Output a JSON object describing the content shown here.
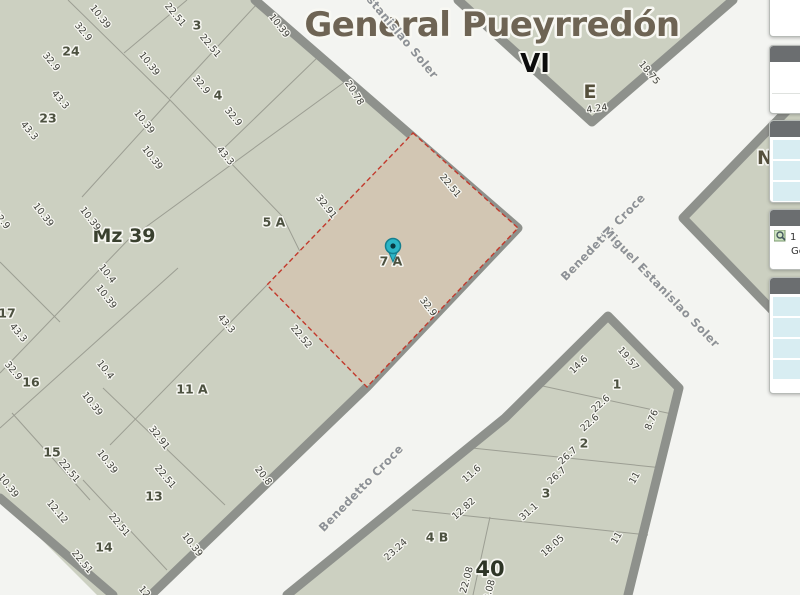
{
  "map": {
    "bg": "#f3f4f1",
    "block_fill": "#ccd0c1",
    "road_color": "#8e918c",
    "parcel_line_color": "#9c9e93",
    "title": "General Pueyrredón",
    "blocks": [
      "0,0 255,0 518,228 367,387 151,595 97,595 0,498",
      "458,0 733,0 592,122",
      "805,92 683,218 805,344",
      "287,595 505,418 608,316 679,388 628,595"
    ],
    "roads": [
      "255,0 518,228 367,387 151,595",
      "0,498 113,595",
      "458,0 592,122 733,0",
      "805,92 683,218 805,344",
      "287,595 505,418 608,316 679,388 628,595"
    ],
    "parcel_lines": [
      "68,0 170,100 283,217 358,370",
      "350,78 128,240 0,373",
      "170,100 82,197",
      "124,53 187,0",
      "170,98 257,4",
      "222,150 318,57",
      "178,268 0,428",
      "103,388 225,505",
      "83,480 167,570",
      "12,413 90,500",
      "0,262 60,322",
      "267,285 110,445",
      "538,385 672,414",
      "472,448 663,468",
      "412,510 648,535",
      "490,517 473,595"
    ],
    "selected_parcel": {
      "label": "7 A",
      "points": "413,133 518,228 367,387 267,285",
      "fill": "#d2c6b3",
      "border": "#c2392c"
    },
    "marker": {
      "x": 393,
      "y": 246,
      "fill": "#2bb5c6",
      "stroke": "#157f8f",
      "dot": "#083840"
    },
    "labels": [
      {
        "t": "General Pueyrredón",
        "x": 492,
        "y": 25,
        "r": 0,
        "k": "title"
      },
      {
        "t": "VI",
        "x": 535,
        "y": 64,
        "r": 0,
        "k": "vi"
      },
      {
        "t": "E",
        "x": 590,
        "y": 92,
        "r": 0,
        "k": "blocksm"
      },
      {
        "t": "N",
        "x": 765,
        "y": 158,
        "r": 0,
        "k": "blocksm"
      },
      {
        "t": "Mz 39",
        "x": 124,
        "y": 236,
        "r": 0,
        "k": "block"
      },
      {
        "t": "40",
        "x": 490,
        "y": 569,
        "r": 0,
        "k": "block40"
      },
      {
        "t": "Estanislao Soler",
        "x": 400,
        "y": 34,
        "r": 50,
        "k": "street"
      },
      {
        "t": "Benedetto Croce",
        "x": 603,
        "y": 237,
        "r": -46,
        "k": "street"
      },
      {
        "t": "Miguel Estanislao Soler",
        "x": 661,
        "y": 287,
        "r": 46,
        "k": "street"
      },
      {
        "t": "Benedetto Croce",
        "x": 361,
        "y": 488,
        "r": -46,
        "k": "street"
      },
      {
        "t": "3",
        "x": 197,
        "y": 25,
        "r": 0,
        "k": "num"
      },
      {
        "t": "24",
        "x": 71,
        "y": 51,
        "r": 0,
        "k": "num"
      },
      {
        "t": "4",
        "x": 218,
        "y": 95,
        "r": 0,
        "k": "num"
      },
      {
        "t": "23",
        "x": 48,
        "y": 118,
        "r": 0,
        "k": "num"
      },
      {
        "t": "5 A",
        "x": 274,
        "y": 222,
        "r": 0,
        "k": "num"
      },
      {
        "t": "7 A",
        "x": 391,
        "y": 261,
        "r": 0,
        "k": "num"
      },
      {
        "t": "17",
        "x": 7,
        "y": 313,
        "r": 0,
        "k": "num"
      },
      {
        "t": "16",
        "x": 31,
        "y": 382,
        "r": 0,
        "k": "num"
      },
      {
        "t": "11 A",
        "x": 192,
        "y": 389,
        "r": 0,
        "k": "num"
      },
      {
        "t": "15",
        "x": 52,
        "y": 452,
        "r": 0,
        "k": "num"
      },
      {
        "t": "13",
        "x": 154,
        "y": 496,
        "r": 0,
        "k": "num"
      },
      {
        "t": "14",
        "x": 104,
        "y": 547,
        "r": 0,
        "k": "num"
      },
      {
        "t": "1",
        "x": 617,
        "y": 384,
        "r": 0,
        "k": "num"
      },
      {
        "t": "2",
        "x": 584,
        "y": 443,
        "r": 0,
        "k": "num"
      },
      {
        "t": "3",
        "x": 546,
        "y": 493,
        "r": 0,
        "k": "num"
      },
      {
        "t": "4 B",
        "x": 437,
        "y": 537,
        "r": 0,
        "k": "num"
      },
      {
        "t": "10.39",
        "x": 100,
        "y": 17,
        "r": 52,
        "k": "dim"
      },
      {
        "t": "22.51",
        "x": 175,
        "y": 15,
        "r": 50,
        "k": "dim"
      },
      {
        "t": "32.9",
        "x": 83,
        "y": 32,
        "r": 50,
        "k": "dim"
      },
      {
        "t": "10.39",
        "x": 149,
        "y": 64,
        "r": 52,
        "k": "dim"
      },
      {
        "t": "22.51",
        "x": 210,
        "y": 46,
        "r": 50,
        "k": "dim"
      },
      {
        "t": "32.9",
        "x": 51,
        "y": 62,
        "r": 50,
        "k": "dim"
      },
      {
        "t": "32.9",
        "x": 201,
        "y": 85,
        "r": 50,
        "k": "dim"
      },
      {
        "t": "43.3",
        "x": 60,
        "y": 100,
        "r": 50,
        "k": "dim"
      },
      {
        "t": "32.9",
        "x": 233,
        "y": 117,
        "r": 50,
        "k": "dim"
      },
      {
        "t": "43.3",
        "x": 29,
        "y": 131,
        "r": 50,
        "k": "dim"
      },
      {
        "t": "10.39",
        "x": 144,
        "y": 122,
        "r": 52,
        "k": "dim"
      },
      {
        "t": "43.3",
        "x": 225,
        "y": 156,
        "r": 50,
        "k": "dim"
      },
      {
        "t": "10.39",
        "x": 152,
        "y": 158,
        "r": 52,
        "k": "dim"
      },
      {
        "t": "10.39",
        "x": 279,
        "y": 26,
        "r": 52,
        "k": "dim"
      },
      {
        "t": "20.78",
        "x": 354,
        "y": 93,
        "r": 58,
        "k": "dim"
      },
      {
        "t": "18.75",
        "x": 649,
        "y": 73,
        "r": 50,
        "k": "dim"
      },
      {
        "t": "4.24",
        "x": 597,
        "y": 109,
        "r": -8,
        "k": "dim"
      },
      {
        "t": "32.9",
        "x": 1,
        "y": 220,
        "r": 50,
        "k": "dim"
      },
      {
        "t": "10.39",
        "x": 43,
        "y": 215,
        "r": 52,
        "k": "dim"
      },
      {
        "t": "10.39",
        "x": 90,
        "y": 219,
        "r": 52,
        "k": "dim"
      },
      {
        "t": "10.4",
        "x": 107,
        "y": 274,
        "r": 52,
        "k": "dim"
      },
      {
        "t": "10.39",
        "x": 106,
        "y": 297,
        "r": 52,
        "k": "dim"
      },
      {
        "t": "43.3",
        "x": 18,
        "y": 333,
        "r": 50,
        "k": "dim"
      },
      {
        "t": "43.3",
        "x": 226,
        "y": 324,
        "r": 50,
        "k": "dim"
      },
      {
        "t": "32.9",
        "x": 13,
        "y": 371,
        "r": 50,
        "k": "dim"
      },
      {
        "t": "10.4",
        "x": 105,
        "y": 370,
        "r": 52,
        "k": "dim"
      },
      {
        "t": "10.39",
        "x": 92,
        "y": 404,
        "r": 52,
        "k": "dim"
      },
      {
        "t": "32.91",
        "x": 326,
        "y": 207,
        "r": 52,
        "k": "dim"
      },
      {
        "t": "22.51",
        "x": 450,
        "y": 186,
        "r": 50,
        "k": "dim"
      },
      {
        "t": "32.9",
        "x": 428,
        "y": 307,
        "r": 52,
        "k": "dim"
      },
      {
        "t": "22.52",
        "x": 301,
        "y": 337,
        "r": 50,
        "k": "dim"
      },
      {
        "t": "32.91",
        "x": 159,
        "y": 438,
        "r": 52,
        "k": "dim"
      },
      {
        "t": "22.51",
        "x": 69,
        "y": 471,
        "r": 50,
        "k": "dim"
      },
      {
        "t": "22.51",
        "x": 165,
        "y": 477,
        "r": 50,
        "k": "dim"
      },
      {
        "t": "10.39",
        "x": 107,
        "y": 462,
        "r": 52,
        "k": "dim"
      },
      {
        "t": "10.39",
        "x": 8,
        "y": 486,
        "r": 52,
        "k": "dim"
      },
      {
        "t": "12.12",
        "x": 57,
        "y": 512,
        "r": 50,
        "k": "dim"
      },
      {
        "t": "22.51",
        "x": 119,
        "y": 525,
        "r": 50,
        "k": "dim"
      },
      {
        "t": "22.51",
        "x": 82,
        "y": 562,
        "r": 50,
        "k": "dim"
      },
      {
        "t": "10.39",
        "x": 192,
        "y": 545,
        "r": 52,
        "k": "dim"
      },
      {
        "t": "20.8",
        "x": 263,
        "y": 476,
        "r": 52,
        "k": "dim"
      },
      {
        "t": "12",
        "x": 144,
        "y": 592,
        "r": 50,
        "k": "dim"
      },
      {
        "t": "19.57",
        "x": 628,
        "y": 359,
        "r": 50,
        "k": "dim"
      },
      {
        "t": "14.6",
        "x": 579,
        "y": 365,
        "r": -45,
        "k": "dim"
      },
      {
        "t": "22.6",
        "x": 601,
        "y": 404,
        "r": -42,
        "k": "dim"
      },
      {
        "t": "22.6",
        "x": 590,
        "y": 423,
        "r": -42,
        "k": "dim"
      },
      {
        "t": "8.76",
        "x": 652,
        "y": 420,
        "r": -68,
        "k": "dim"
      },
      {
        "t": "26.7",
        "x": 568,
        "y": 456,
        "r": -42,
        "k": "dim"
      },
      {
        "t": "26.7",
        "x": 557,
        "y": 476,
        "r": -42,
        "k": "dim"
      },
      {
        "t": "11",
        "x": 635,
        "y": 478,
        "r": -60,
        "k": "dim"
      },
      {
        "t": "31.1",
        "x": 529,
        "y": 512,
        "r": -42,
        "k": "dim"
      },
      {
        "t": "18.05",
        "x": 553,
        "y": 546,
        "r": -42,
        "k": "dim"
      },
      {
        "t": "11",
        "x": 617,
        "y": 538,
        "r": -60,
        "k": "dim"
      },
      {
        "t": "11.6",
        "x": 472,
        "y": 474,
        "r": -42,
        "k": "dim"
      },
      {
        "t": "12.82",
        "x": 464,
        "y": 509,
        "r": -42,
        "k": "dim"
      },
      {
        "t": "23.24",
        "x": 396,
        "y": 550,
        "r": -42,
        "k": "dim"
      },
      {
        "t": "22.08",
        "x": 467,
        "y": 580,
        "r": -75,
        "k": "dim"
      },
      {
        "t": "22.08",
        "x": 489,
        "y": 593,
        "r": -75,
        "k": "dim"
      }
    ]
  },
  "panels": {
    "header_color": "#6b6e70",
    "row_color": "#d8edf2",
    "items": [
      {
        "top": -9,
        "height": 46,
        "type": "plain"
      },
      {
        "top": 45,
        "height": 69,
        "type": "divided"
      },
      {
        "top": 120,
        "height": 83,
        "type": "rows",
        "rows": 3
      },
      {
        "top": 209,
        "height": 61,
        "type": "info",
        "line1": "1",
        "line2": "Ge",
        "icon": "map-zoom-icon"
      },
      {
        "top": 277,
        "height": 117,
        "type": "rows",
        "rows": 4
      }
    ]
  }
}
